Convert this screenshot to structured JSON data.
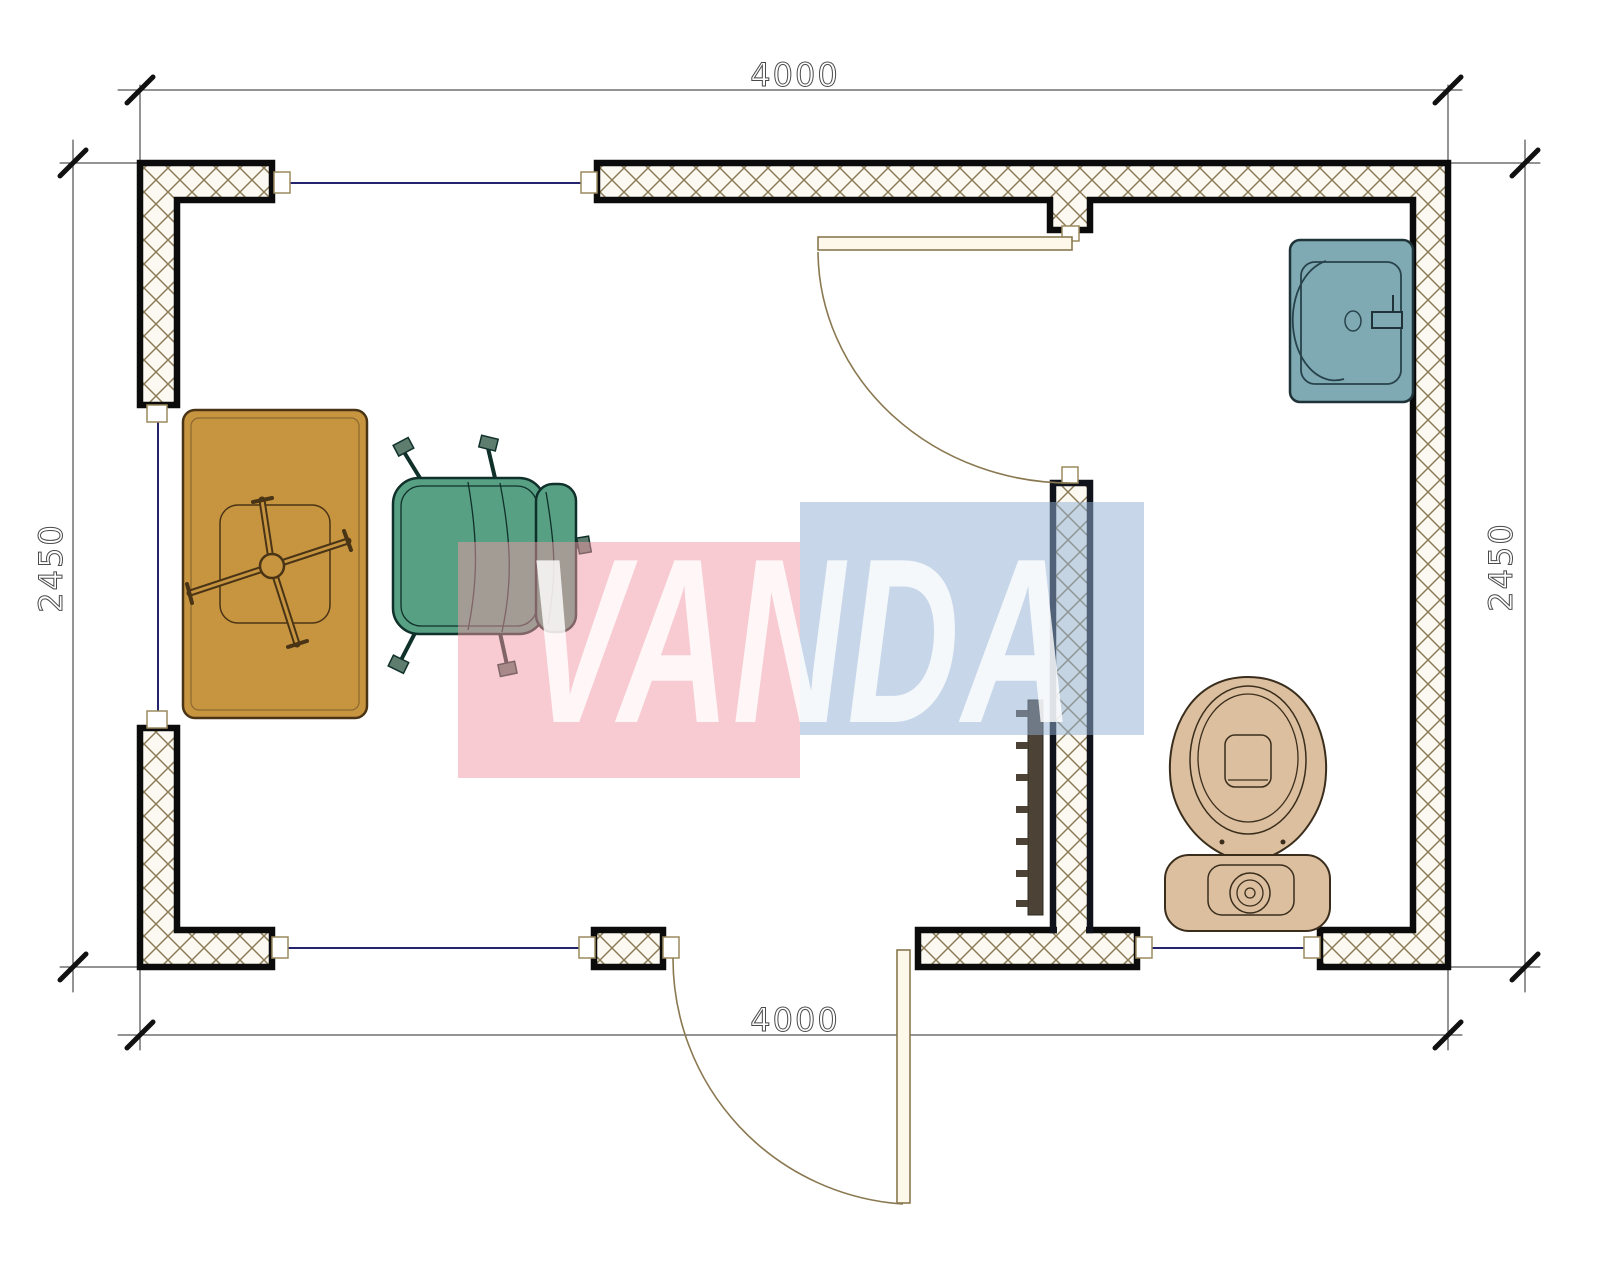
{
  "drawing": {
    "type": "bungalow-floor-plan",
    "dims": {
      "top": "4000",
      "bottom": "4000",
      "left": "2450",
      "right": "2450"
    },
    "watermark": {
      "text": "VANDA",
      "pink": "#ef98a4",
      "blue": "#8fb0d4",
      "letter_color": "#ffffff"
    },
    "palette": {
      "wall_outline": "#0b0b0b",
      "hatch_line": "#8d7c57",
      "hatch_bg": "#fbf9f1",
      "window_line": "#23236e",
      "door_arc": "#8a7850",
      "door_leaf": "#fdf8ea",
      "jamb_outline": "#9c8a5e",
      "desk": "#c79440",
      "desk_outline": "#4a3416",
      "chair": "#57a084",
      "chair_outline": "#10302a",
      "sink": "#7fa9b3",
      "sink_outline": "#1f3338",
      "toilet": "#dcbf9f",
      "toilet_outline": "#3a2d1c",
      "radiator": "#4c4336",
      "dim_text": "#4a4a4a"
    },
    "elements": [
      "exterior-walls",
      "interior-partition-wall",
      "window-top",
      "window-left",
      "window-bottom-left",
      "window-bathroom",
      "door-bathroom",
      "door-entrance",
      "desk",
      "office-chair",
      "sink",
      "toilet",
      "radiator"
    ]
  }
}
